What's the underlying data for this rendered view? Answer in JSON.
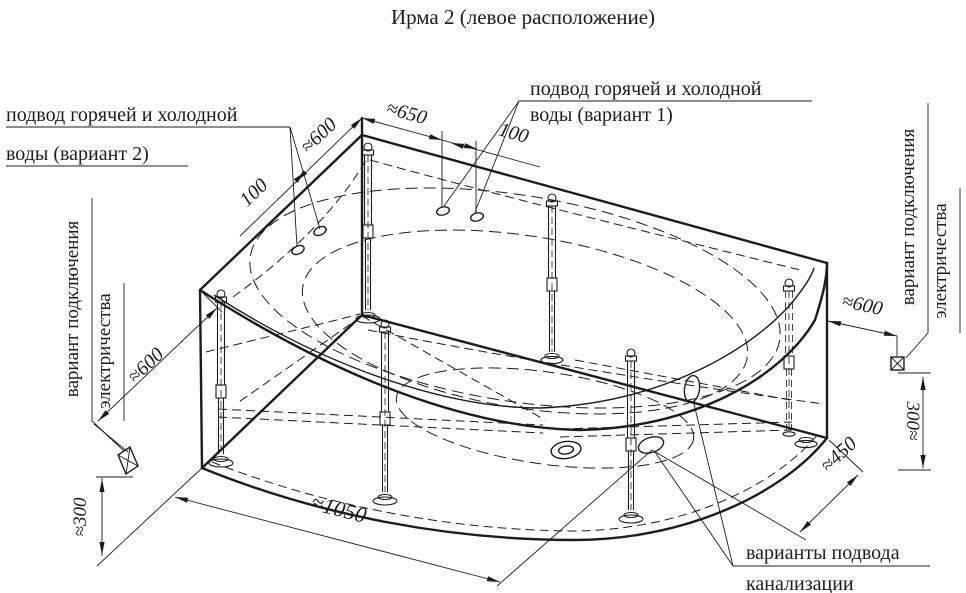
{
  "title": "Ирма 2 (левое расположение)",
  "labels": {
    "water_variant_2": {
      "line1": "подвод горячей и холодной",
      "line2": "воды (вариант 2)"
    },
    "water_variant_1": {
      "line1": "подвод горячей и холодной",
      "line2": "воды (вариант 1)"
    },
    "electric_left": {
      "line1": "вариант подключения",
      "line2": "электричества"
    },
    "electric_right": {
      "line1": "вариант подключения",
      "line2": "электричества"
    },
    "sewer": {
      "line1": "варианты подвода",
      "line2": "канализации"
    }
  },
  "dimensions": {
    "left_holes_offset": "≈600",
    "left_holes_spacing": "100",
    "right_holes_offset": "≈650",
    "right_holes_spacing": "100",
    "left_electric_offset": "≈600",
    "left_electric_height": "≈300",
    "right_electric_offset": "≈600",
    "right_electric_height": "300≈",
    "sewer_offset": "≈450",
    "front_width": "≈1050"
  },
  "colors": {
    "line": "#1c1c1c",
    "background": "#ffffff"
  }
}
